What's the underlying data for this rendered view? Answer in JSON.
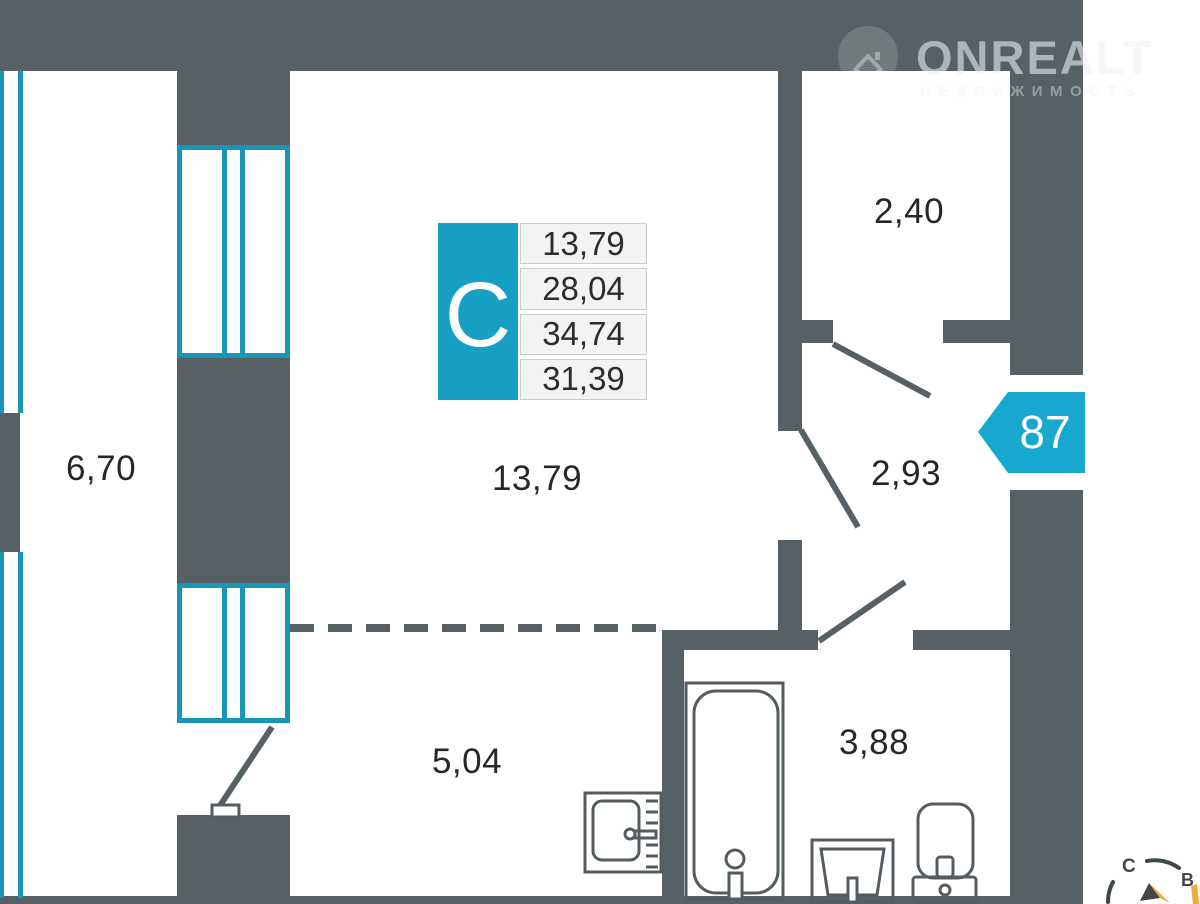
{
  "logo": {
    "brand": "ONREALT",
    "tagline": "НЕДВИЖИМОСТЬ"
  },
  "unit_badge": "87",
  "info_card": {
    "type_letter": "С",
    "values": [
      "13,79",
      "28,04",
      "34,74",
      "31,39"
    ]
  },
  "room_labels": {
    "balcony": "6,70",
    "living": "13,79",
    "room_top": "2,40",
    "hall": "2,93",
    "kitchen": "5,04",
    "bath": "3,88"
  },
  "compass": {
    "north_label": "С",
    "east_label": "В"
  },
  "colors": {
    "paper": "#FFFFFF",
    "wall": "#566065",
    "window": "#1995B5",
    "accent": "#18A7CE",
    "accent_block": "#17A0C4",
    "row_bg": "#F3F3F3",
    "row_border": "#C9CDCE",
    "label_text": "#25282A",
    "fixture": "#545C60",
    "compass_yellow": "#F2A93B"
  }
}
